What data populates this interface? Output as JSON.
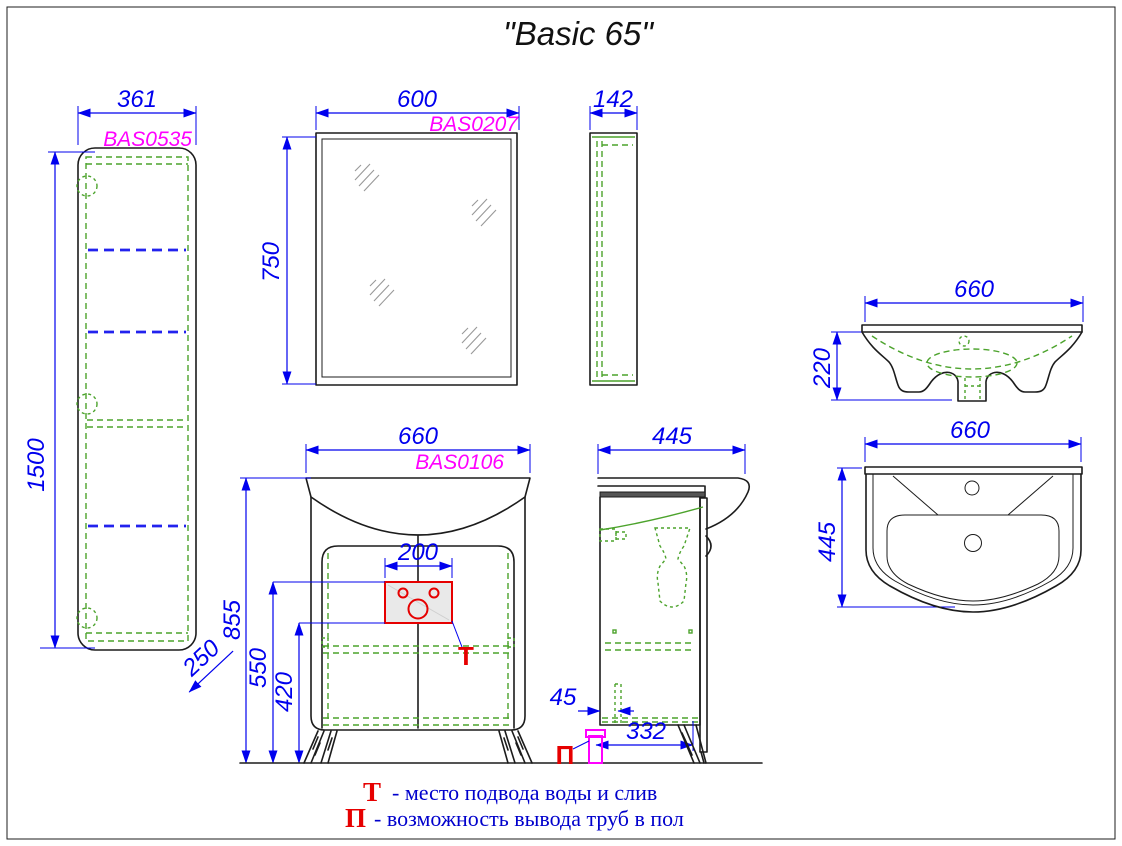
{
  "title": "\"Basic 65\"",
  "colors": {
    "dimension_blue": "#0000ee",
    "shelf_blue": "#2222ee",
    "code_magenta": "#ff00ff",
    "hidden_green": "#4ca32c",
    "marker_red": "#e60000",
    "outline_black": "#1c1c1c"
  },
  "views": {
    "side_cabinet": {
      "code": "BAS0535",
      "dims": {
        "width": "361",
        "height": "1500",
        "depth": "250"
      }
    },
    "mirror_front": {
      "code": "BAS0207",
      "dims": {
        "width": "600",
        "height": "750"
      }
    },
    "mirror_side": {
      "dims": {
        "depth": "142"
      }
    },
    "vanity_front": {
      "code": "BAS0106",
      "marker": "Т",
      "dims": {
        "width": "660",
        "total_height": "855",
        "supply_top_height": "550",
        "supply_bottom_height": "420",
        "supply_zone_width": "200"
      }
    },
    "vanity_side": {
      "marker": "П",
      "dims": {
        "depth": "445",
        "pipe_wall_offset": "45",
        "pipe_to_front": "332"
      }
    },
    "washbasin_front": {
      "dims": {
        "width": "660",
        "height": "220"
      }
    },
    "washbasin_top": {
      "dims": {
        "width": "660",
        "depth": "445"
      }
    }
  },
  "legend": {
    "items": [
      {
        "symbol": "Т",
        "text": "- место подвода воды и слив"
      },
      {
        "symbol": "П",
        "text": "- возможность вывода труб в пол"
      }
    ]
  }
}
